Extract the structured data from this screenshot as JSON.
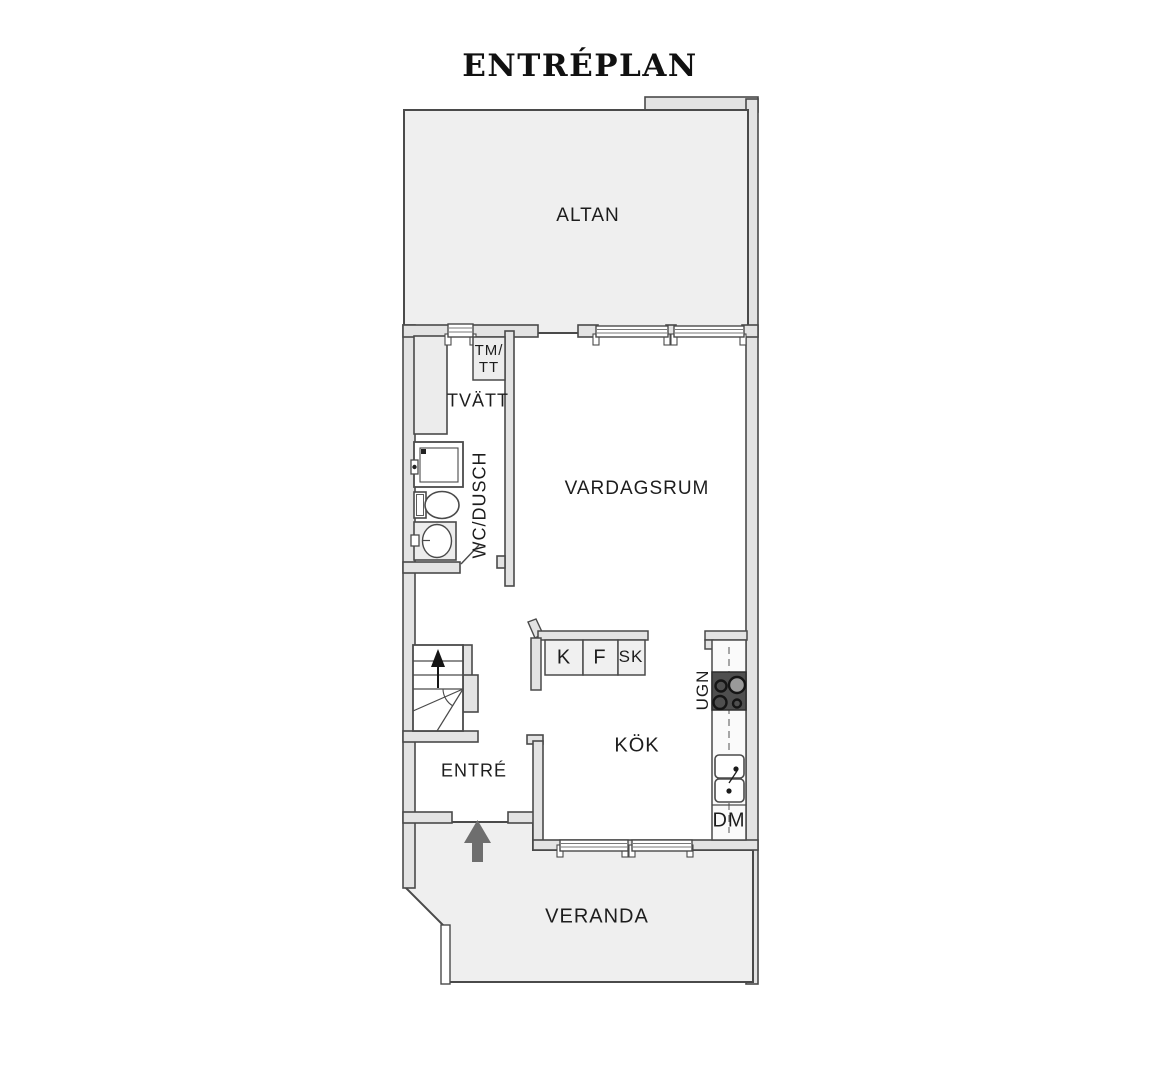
{
  "title": "ENTRÉPLAN",
  "labels": {
    "altan": "ALTAN",
    "tm_tt_line1": "TM/",
    "tm_tt_line2": "TT",
    "tvatt": "TVÄTT",
    "wc_dusch": "WC/DUSCH",
    "vardagsrum": "VARDAGSRUM",
    "kyl": "K",
    "frys": "F",
    "skap": "SK",
    "ugn": "UGN",
    "kok": "KÖK",
    "entre": "ENTRÉ",
    "dm": "DM",
    "veranda": "VERANDA"
  },
  "colors": {
    "outdoor_floor": "#efefef",
    "wall_fill": "#e3e3e3",
    "outline": "#4a4a4a",
    "stove_dark": "#4f4f4f",
    "entrance_arrow": "#6e6e6e",
    "text": "#1d1d1d"
  },
  "icons": {
    "entrance_arrow": "up-arrow",
    "stairs_direction": "up-arrow",
    "stove": "four-burner-hob",
    "sink": "double-basin-sink"
  }
}
